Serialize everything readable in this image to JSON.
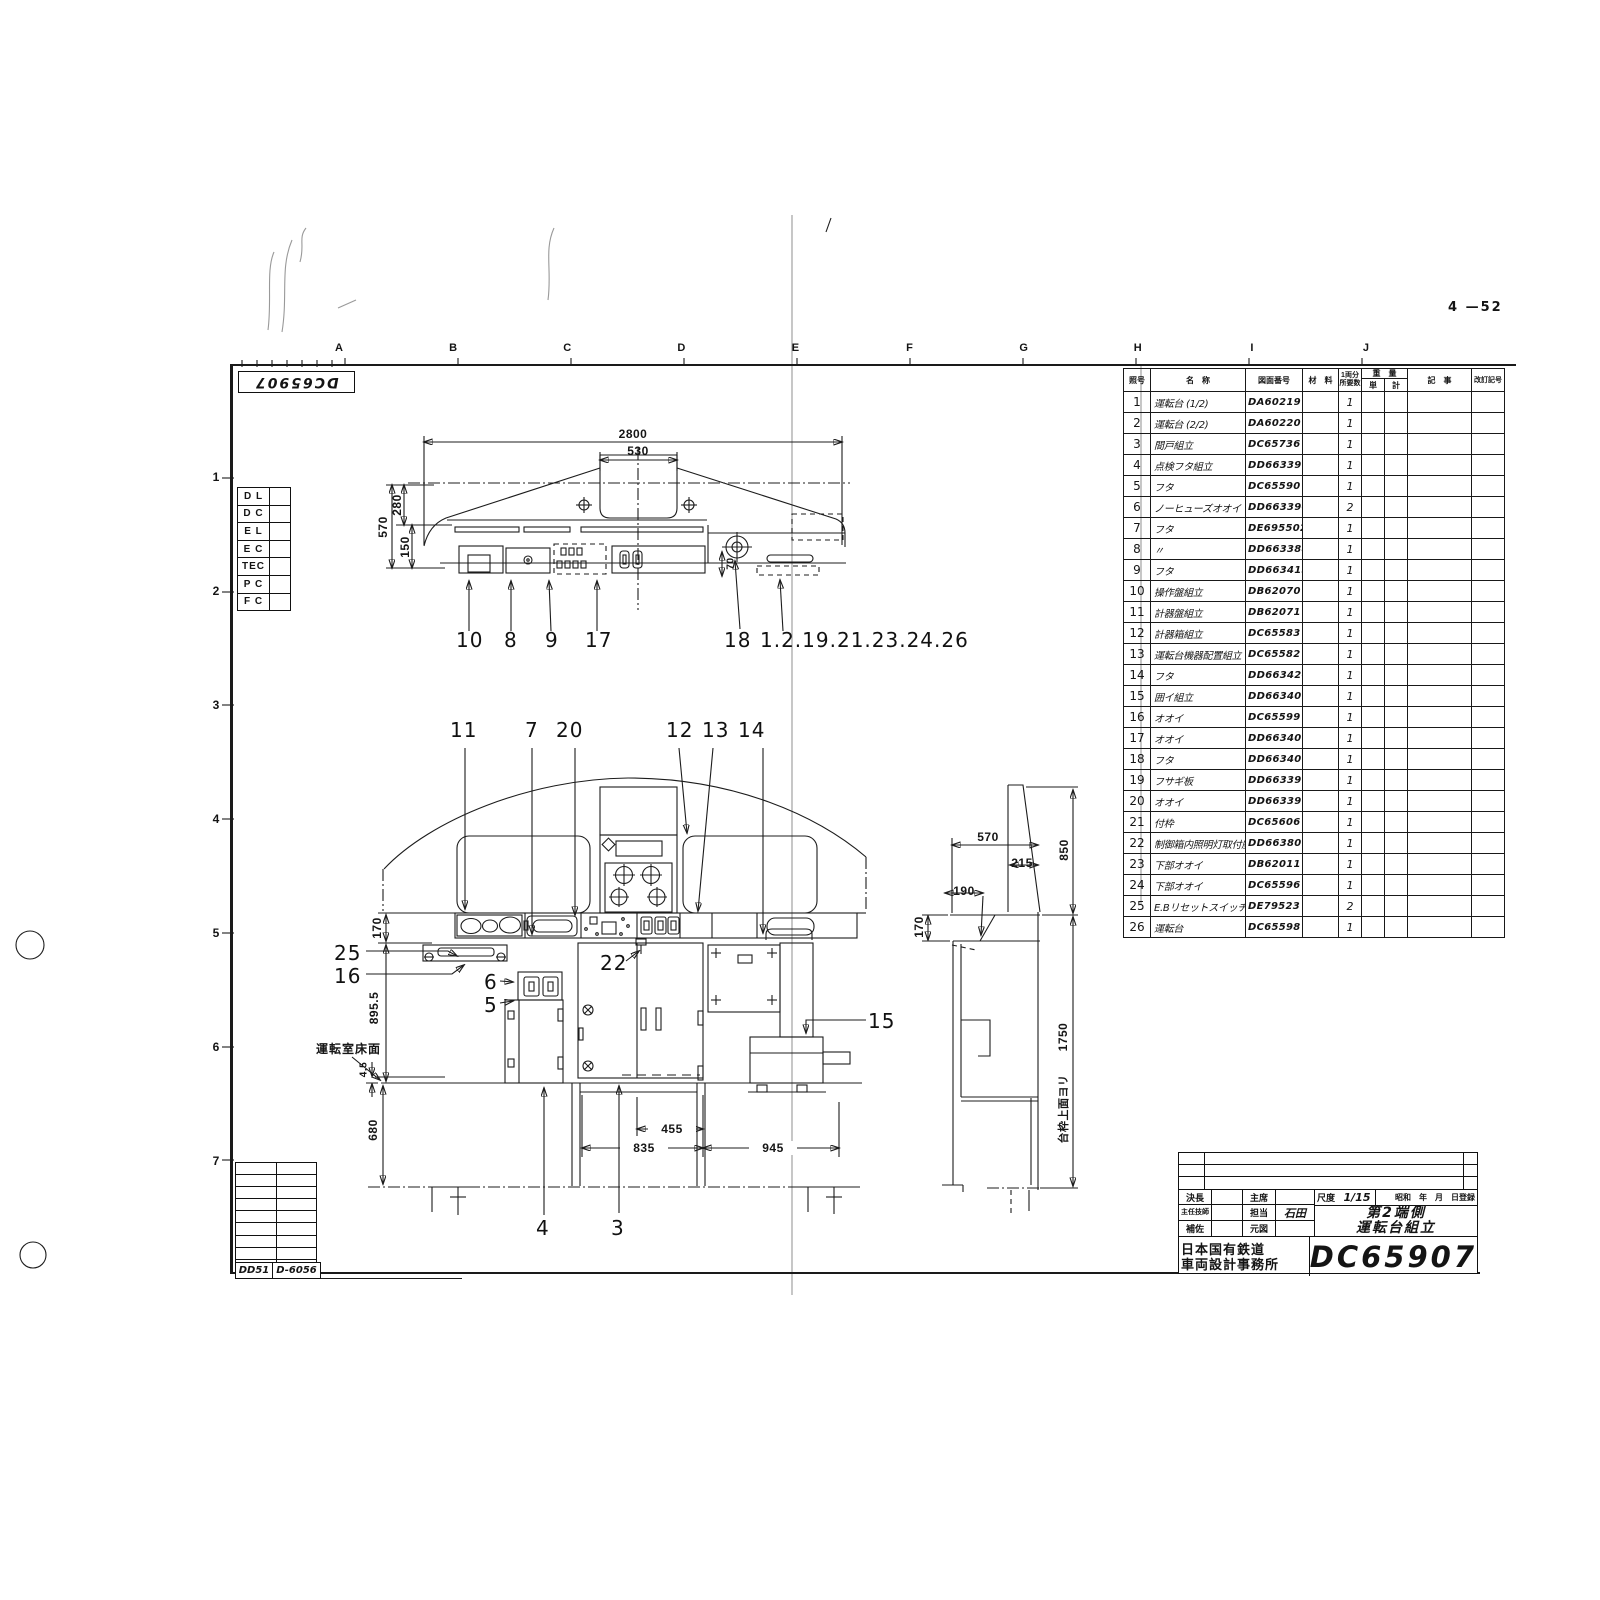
{
  "page": {
    "sheet_no": "4 —52"
  },
  "corner_stamp": {
    "drawing_no": "DC65907"
  },
  "grid": {
    "letters": [
      {
        "label": "A"
      },
      {
        "label": "B"
      },
      {
        "label": "C"
      },
      {
        "label": "D"
      },
      {
        "label": "E"
      },
      {
        "label": "F"
      },
      {
        "label": "G"
      },
      {
        "label": "H"
      },
      {
        "label": "I"
      },
      {
        "label": "J"
      }
    ],
    "numbers": [
      {
        "label": "1"
      },
      {
        "label": "2"
      },
      {
        "label": "3"
      },
      {
        "label": "4"
      },
      {
        "label": "5"
      },
      {
        "label": "6"
      },
      {
        "label": "7"
      }
    ]
  },
  "left_reference_table": {
    "rows": [
      {
        "label": "D L"
      },
      {
        "label": "D C"
      },
      {
        "label": "E L"
      },
      {
        "label": "E C"
      },
      {
        "label": "TEC"
      },
      {
        "label": "P C"
      },
      {
        "label": "F C"
      }
    ]
  },
  "parts_table": {
    "headers": {
      "no": "照号",
      "name": "名　称",
      "dwg": "図面番号",
      "material": "材　料",
      "qty_top": "1両分",
      "qty_bottom": "所要数",
      "weight": "重　量",
      "weight_unit": "単",
      "weight_total": "計",
      "remarks": "記　事",
      "revision": "改訂記号"
    },
    "rows": [
      {
        "no": "1",
        "name": "運転台 (1/2)",
        "dwg": "DA60219",
        "qty": "1"
      },
      {
        "no": "2",
        "name": "運転台 (2/2)",
        "dwg": "DA60220",
        "qty": "1"
      },
      {
        "no": "3",
        "name": "間戸組立",
        "dwg": "DC65736",
        "qty": "1"
      },
      {
        "no": "4",
        "name": "点検フタ組立",
        "dwg": "DD663396",
        "qty": "1"
      },
      {
        "no": "5",
        "name": "フタ",
        "dwg": "DC65590",
        "qty": "1"
      },
      {
        "no": "6",
        "name": "ノーヒューズオオイ",
        "dwg": "DD663390",
        "qty": "2"
      },
      {
        "no": "7",
        "name": "フタ",
        "dwg": "DE695502",
        "qty": "1"
      },
      {
        "no": "8",
        "name": "〃",
        "dwg": "DD663388",
        "qty": "1"
      },
      {
        "no": "9",
        "name": "フタ",
        "dwg": "DD663415",
        "qty": "1"
      },
      {
        "no": "10",
        "name": "操作盤組立",
        "dwg": "DB62070",
        "qty": "1"
      },
      {
        "no": "11",
        "name": "計器盤組立",
        "dwg": "DB62071",
        "qty": "1"
      },
      {
        "no": "12",
        "name": "計器箱組立",
        "dwg": "DC65583",
        "qty": "1"
      },
      {
        "no": "13",
        "name": "運転台機器配置組立",
        "dwg": "DC65582",
        "qty": "1"
      },
      {
        "no": "14",
        "name": "フタ",
        "dwg": "DD663420",
        "qty": "1"
      },
      {
        "no": "15",
        "name": "囲イ組立",
        "dwg": "DD663409",
        "qty": "1"
      },
      {
        "no": "16",
        "name": "オオイ",
        "dwg": "DC65599",
        "qty": "1"
      },
      {
        "no": "17",
        "name": "オオイ",
        "dwg": "DD663406",
        "qty": "1"
      },
      {
        "no": "18",
        "name": "フタ",
        "dwg": "DD663407",
        "qty": "1"
      },
      {
        "no": "19",
        "name": "フサギ板",
        "dwg": "DD663399",
        "qty": "1"
      },
      {
        "no": "20",
        "name": "オオイ",
        "dwg": "DD663391",
        "qty": "1"
      },
      {
        "no": "21",
        "name": "付枠",
        "dwg": "DC65606",
        "qty": "1"
      },
      {
        "no": "22",
        "name": "制御箱内照明灯取付座",
        "dwg": "DD663809",
        "qty": "1"
      },
      {
        "no": "23",
        "name": "下部オオイ",
        "dwg": "DB62011",
        "qty": "1"
      },
      {
        "no": "24",
        "name": "下部オオイ",
        "dwg": "DC65596",
        "qty": "1"
      },
      {
        "no": "25",
        "name": "E.Bリセットスイッチ付板",
        "dwg": "DE79523",
        "qty": "2"
      },
      {
        "no": "26",
        "name": "運転台",
        "dwg": "DC65598",
        "qty": "1"
      }
    ]
  },
  "views": {
    "top": {
      "dims": {
        "overall": "2800",
        "recess": "530",
        "left_outer": "570",
        "left_upper": "280",
        "left_lower": "150",
        "offset": "70"
      },
      "callouts": {
        "c10": "10",
        "c8": "8",
        "c9": "9",
        "c17": "17",
        "c18": "18",
        "group": "1.2.19.21.23.24.26"
      }
    },
    "front": {
      "dims": {
        "sill": "170",
        "height": "895.5",
        "floor_plate": "4.5",
        "under": "680",
        "w455": "455",
        "w835": "835",
        "w945": "945"
      },
      "floor_label": "運転室床面",
      "callouts": {
        "c11": "11",
        "c7": "7",
        "c20": "20",
        "c12": "12",
        "c13": "13",
        "c14": "14",
        "c25": "25",
        "c16": "16",
        "c6": "6",
        "c5": "5",
        "c22": "22",
        "c15": "15",
        "c4": "4",
        "c3": "3"
      }
    },
    "side": {
      "dims": {
        "w570": "570",
        "w215": "215",
        "w190": "190",
        "h170": "170",
        "h850": "850",
        "h1750": "1750"
      },
      "ref_label": "台枠上面ヨリ"
    }
  },
  "bottom_left": {
    "series": "DD51",
    "code": "D-6056"
  },
  "title_block": {
    "approvals": {
      "kecho": "決長",
      "shuseki": "主席",
      "shunin": "主任技師",
      "tanto": "担当",
      "tanto_name": "石田",
      "hosa": "補佐",
      "genzu": "元図"
    },
    "scale_label": "尺度",
    "scale_value": "1/15",
    "date_label": "昭和　年　月　日登録",
    "title_line1": "第2端側",
    "title_line2": "運転台組立",
    "org_line1": "日本国有鉄道",
    "org_line2": "車両設計事務所",
    "drawing_no": "DC65907"
  }
}
